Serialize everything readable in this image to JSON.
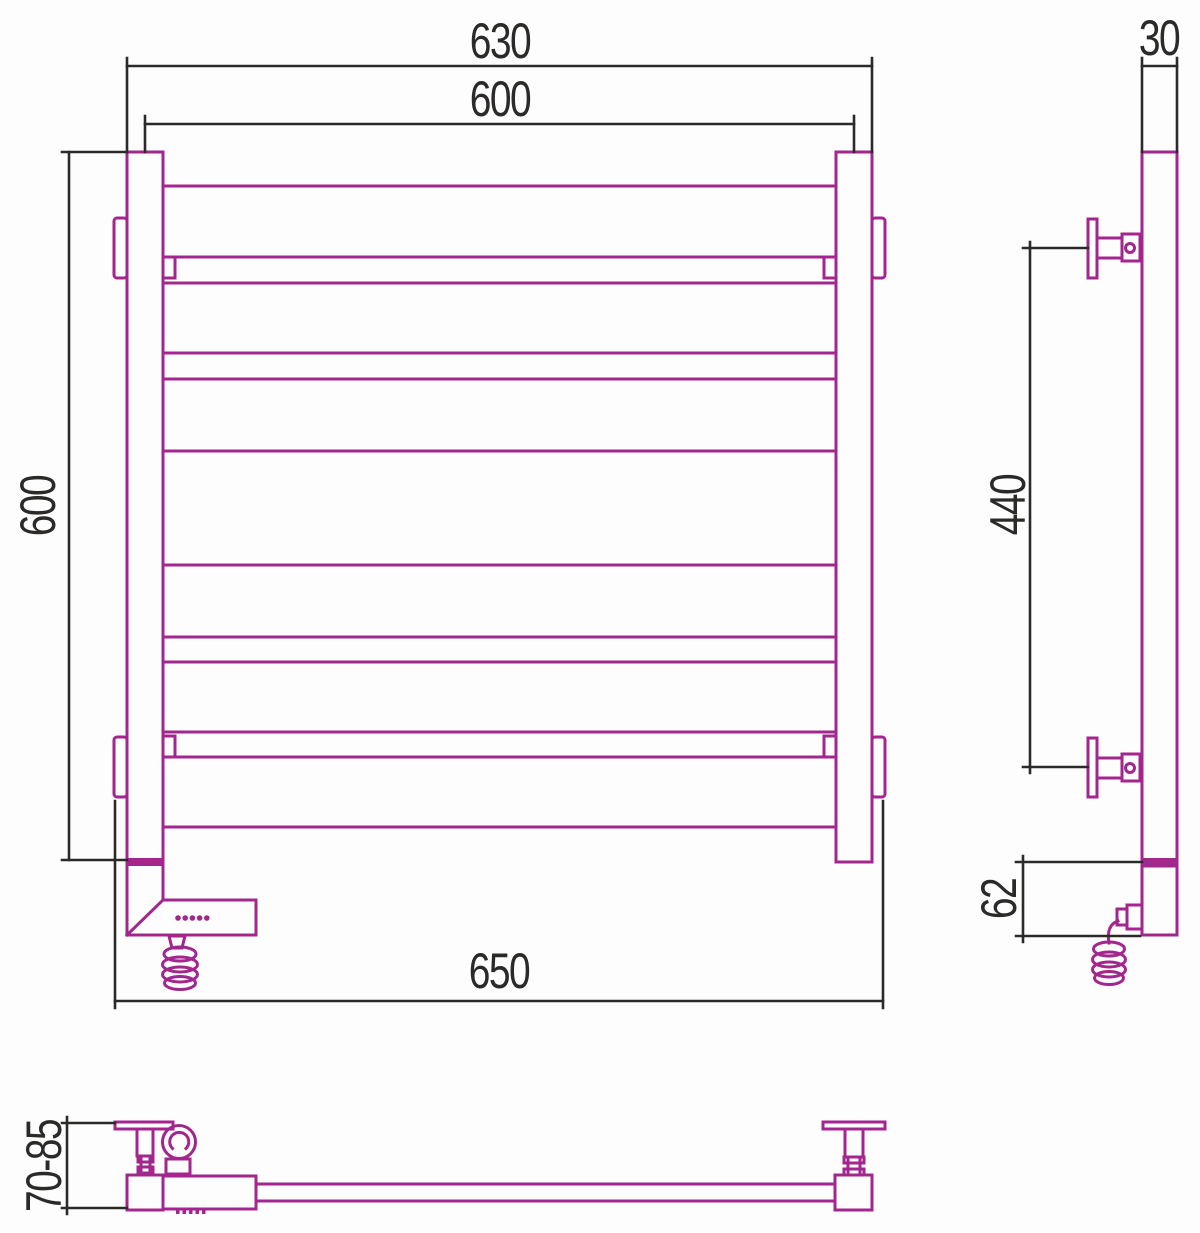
{
  "colors": {
    "product": "#A2268E",
    "dimension": "#2B2A29",
    "background": "#FDFDFD"
  },
  "views": {
    "front": {
      "dims": {
        "outer_width": "630",
        "axis_width": "600",
        "height": "600",
        "bracket_span": "650"
      }
    },
    "side": {
      "dims": {
        "post_depth": "30",
        "bracket_spacing": "440",
        "heater_height": "62"
      }
    },
    "plan": {
      "dims": {
        "wall_clearance": "70-85"
      }
    }
  }
}
